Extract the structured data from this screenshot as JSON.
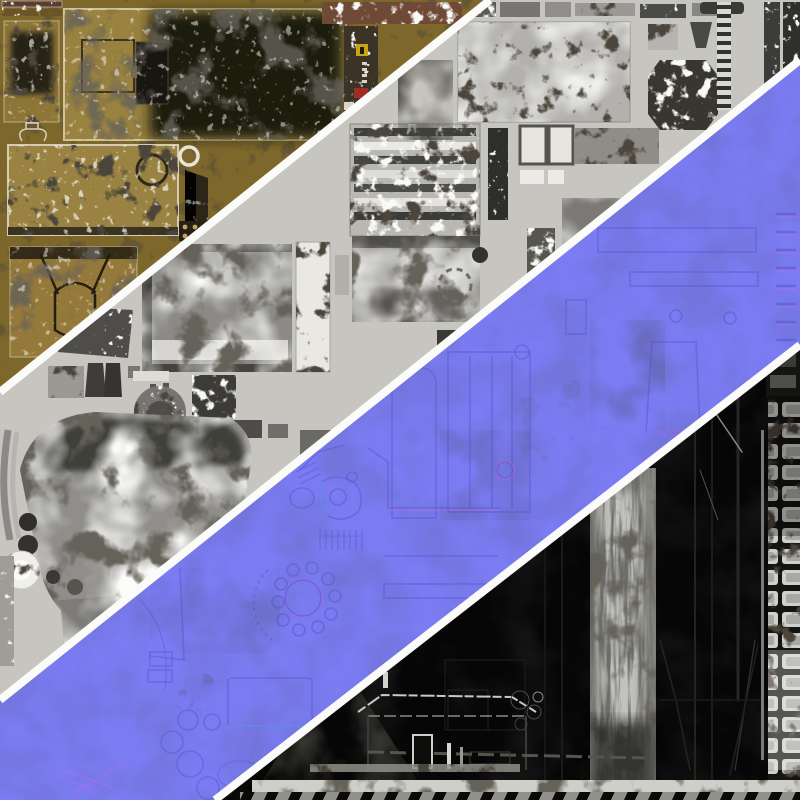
{
  "image": {
    "type": "texture-atlas-composite",
    "description": "Four diagonal bands of PBR texture atlas maps (diffuse, grayscale roughness, normal map, specular/wear) separated by white diagonal divider stripes",
    "width": 800,
    "height": 800
  },
  "dividers": {
    "color": "#fbfbfa",
    "count": 3
  },
  "bands": [
    {
      "id": "diffuse",
      "label": "diffuse-albedo-map-band",
      "background": "#7d672a",
      "accents": [
        "#99823f",
        "#211c11",
        "#c8a418",
        "#a32c22",
        "#cfc49f"
      ]
    },
    {
      "id": "roughness",
      "label": "grayscale-roughness-map-band",
      "background": "#c7c5c0",
      "accents": [
        "#8b8a86",
        "#3c3b38",
        "#e9e8e3",
        "#2e2e2b"
      ]
    },
    {
      "id": "normal",
      "label": "normal-map-band",
      "background": "#7b7cf2",
      "accents": [
        "#5a5bd4",
        "#c46ae2",
        "#62d0ea",
        "#9fa0fa"
      ]
    },
    {
      "id": "specular",
      "label": "specular-wear-map-band",
      "background": "#060606",
      "accents": [
        "#8f8f8c",
        "#d6d6d2",
        "#c9c9c2",
        "#232321"
      ]
    }
  ]
}
